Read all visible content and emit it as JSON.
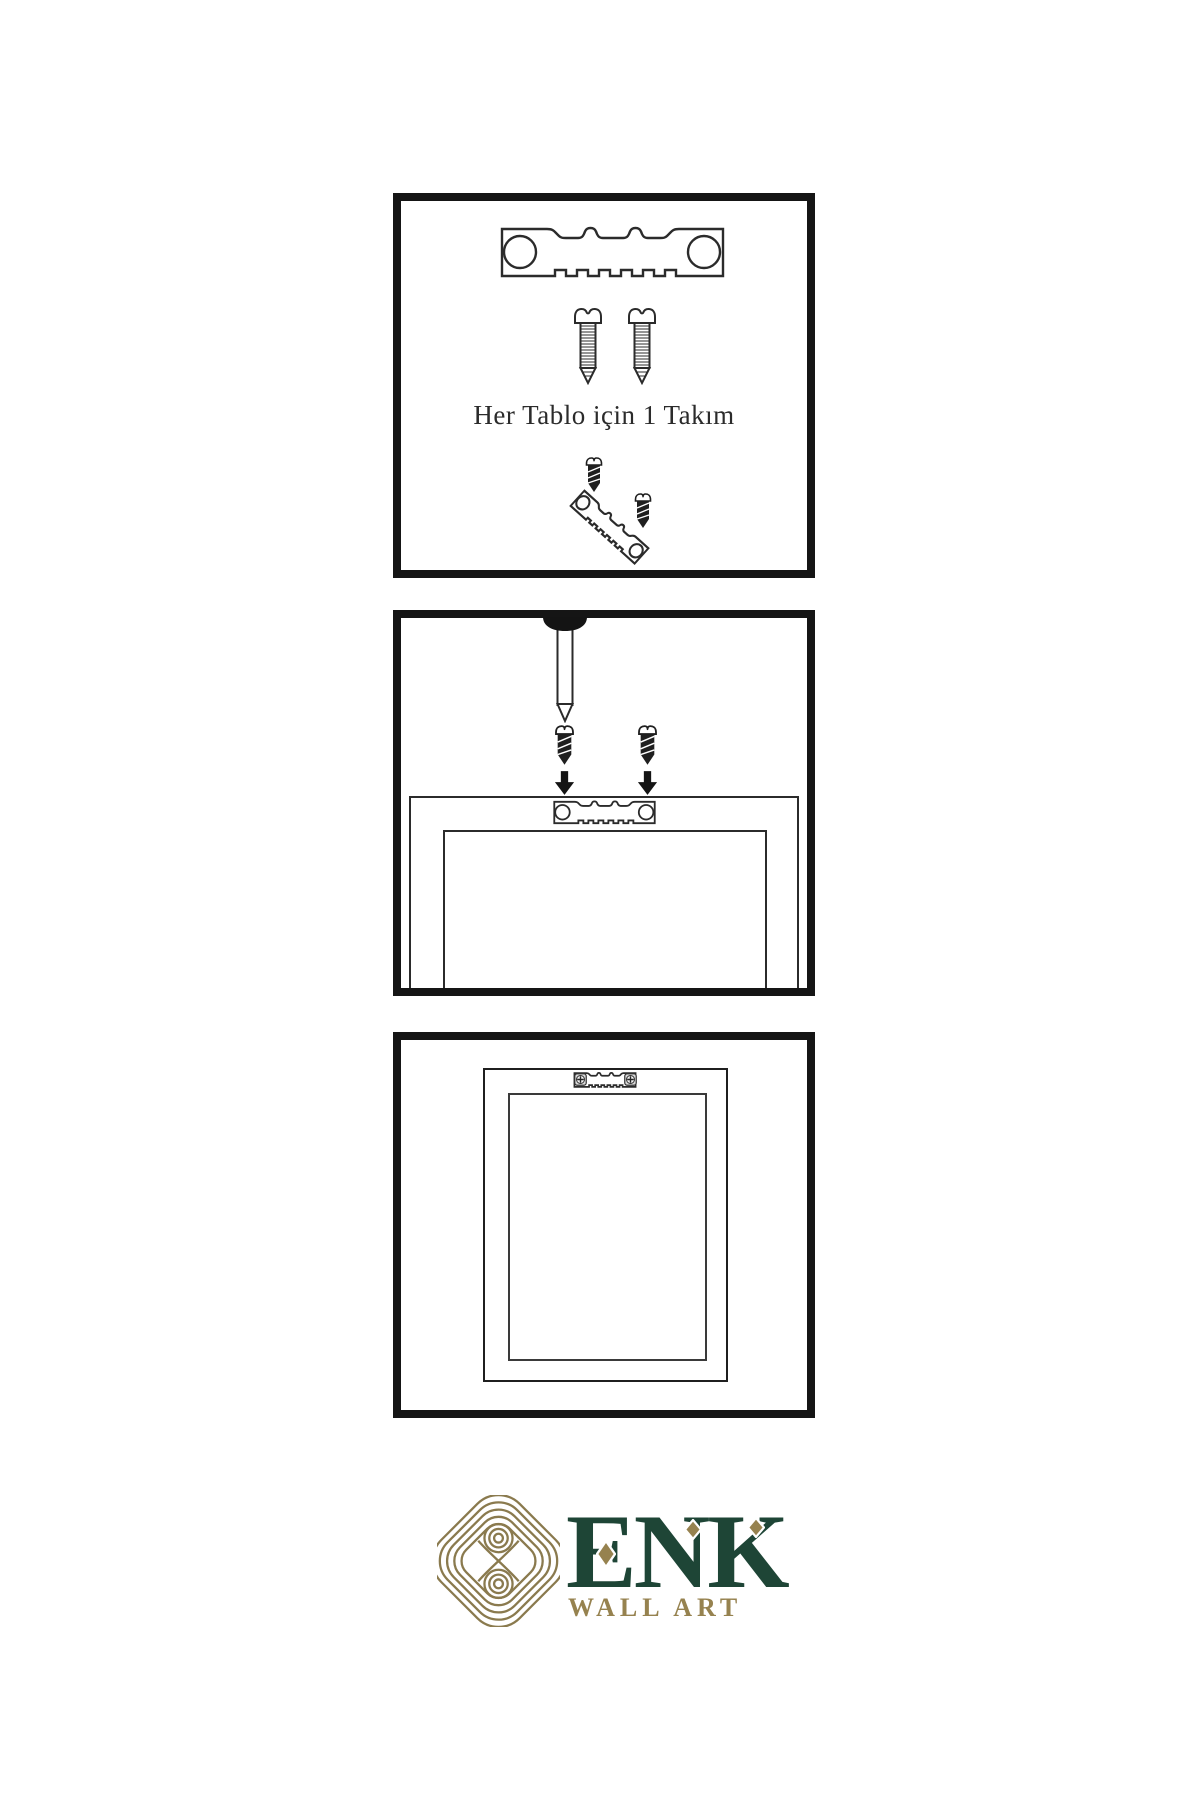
{
  "image": {
    "kind": "wall-art-hanging-instructions"
  },
  "colors": {
    "background": "#ffffff",
    "panel_border": "#151515",
    "line_art": "#2b2b2b",
    "hardware_dark": "#1f1f1f",
    "logo_green": "#1e4536",
    "logo_gold": "#96824f",
    "knot_gold": "#8a7a4e"
  },
  "step1": {
    "caption": "Her Tablo için 1 Takım",
    "icons": [
      "sawtooth-hanger-icon",
      "screw-icon",
      "screw-icon",
      "screw-dark-icon",
      "sawtooth-hanger-tilted-icon",
      "screw-dark-icon"
    ]
  },
  "step2": {
    "icons": [
      "nail-icon",
      "screw-dark-icon",
      "screw-dark-icon",
      "arrow-down-icon",
      "arrow-down-icon",
      "sawtooth-hanger-icon",
      "frame-back-outline"
    ]
  },
  "step3": {
    "icons": [
      "frame-back-outline",
      "sawtooth-hanger-mounted-icon",
      "phillips-screw-icon",
      "phillips-screw-icon"
    ]
  },
  "logo": {
    "brand": "ENK",
    "tagline": "WALL ART",
    "icon": "interlaced-knot-icon"
  }
}
